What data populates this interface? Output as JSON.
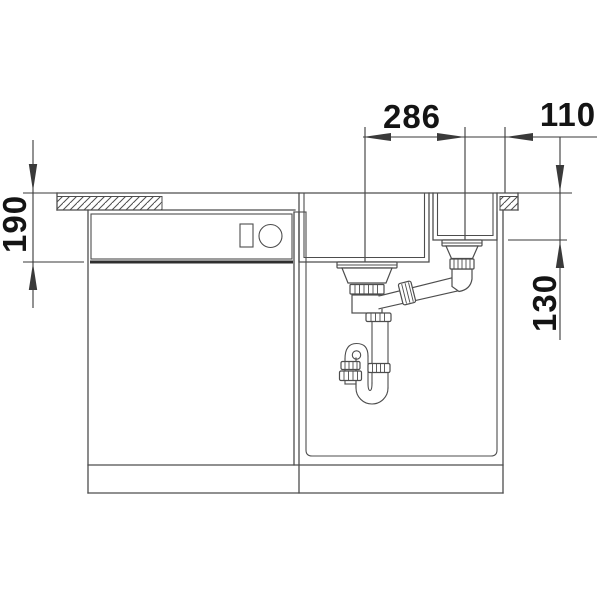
{
  "drawing": {
    "type": "sink-installation-section",
    "dimensions": {
      "bowl_spacing": {
        "value": "286",
        "orientation": "horizontal"
      },
      "right_offset": {
        "value": "110",
        "orientation": "horizontal"
      },
      "front_height": {
        "value": "190",
        "orientation": "vertical"
      },
      "bowl_depth": {
        "value": "130",
        "orertation": "vertical"
      }
    },
    "components": [
      "countertop",
      "dishwasher-cabinet",
      "control-panel",
      "sink-cabinet",
      "main-bowl",
      "secondary-bowl",
      "main-strainer",
      "secondary-strainer",
      "connecting-pipe",
      "siphon-trap"
    ],
    "colors": {
      "line": "#4d4d4d",
      "dim": "#3a3a3a",
      "dark": "#2e2e2e",
      "text": "#141414",
      "background": "#ffffff"
    }
  }
}
